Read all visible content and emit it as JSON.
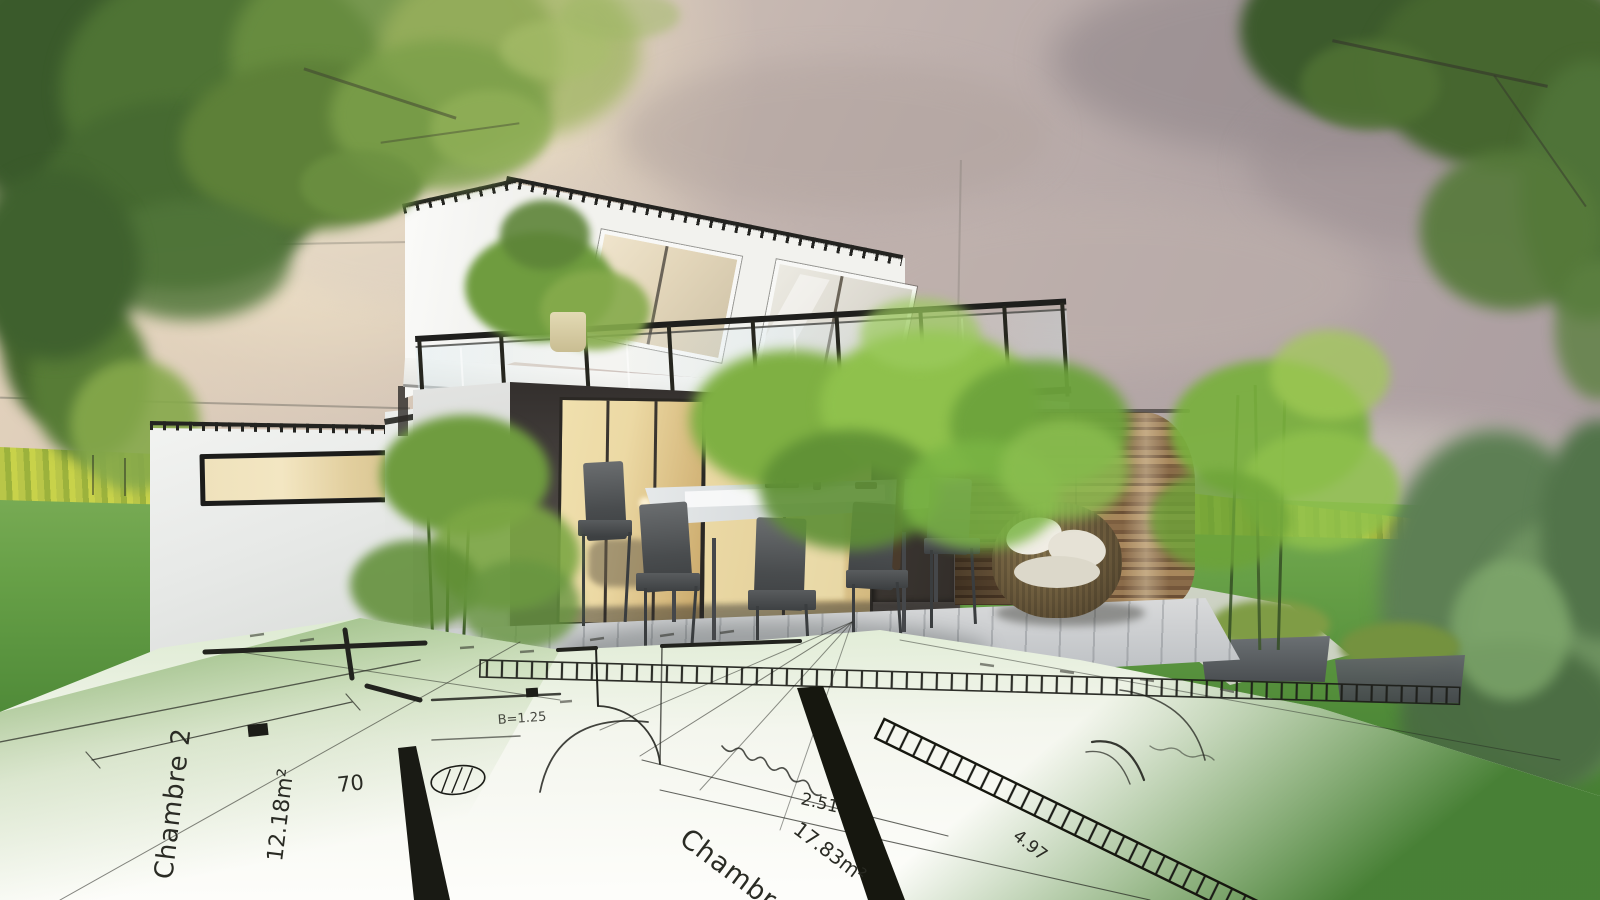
{
  "scene": {
    "kind": "architectural-3d-render-with-floorplan-overlay",
    "palette": {
      "sky_mauve": "#b3a6a6",
      "sun_glow": "#fdf6e0",
      "foliage_green": "#6f9c3f",
      "lawn_green": "#5f9c3f",
      "hedge_yellow_green": "#b9c648",
      "house_white": "#f4f4f1",
      "roof_trim": "#232320",
      "glass_warm": "#ecd9a4",
      "door_charcoal": "#37322e",
      "wood_brown": "#8a6b49",
      "terrace_grey": "#cfd0d2",
      "blueprint_paper": "#f4f6ee",
      "blueprint_ink": "#22231e"
    }
  },
  "blueprint": {
    "labels": {
      "room2_name": "Chambre 2",
      "room2_area": "12.18m²",
      "room3_name": "Chambre 3",
      "room3_area": "17.83m²",
      "dim_70": "70",
      "dim_2_51": "2.51",
      "dim_4_97": "4.97",
      "dim_b": "B=1.25"
    }
  }
}
